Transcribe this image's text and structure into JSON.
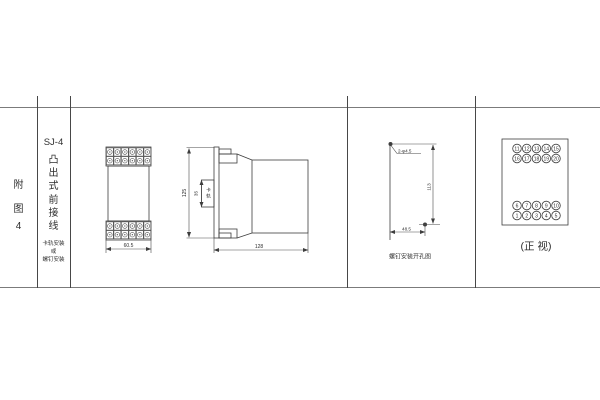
{
  "page": {
    "background": "#ffffff",
    "line_color": "#3d3d3d"
  },
  "title_block": {
    "figure_chars": [
      "附",
      "图",
      "4"
    ],
    "model": "SJ-4",
    "type_chars": [
      "凸",
      "出",
      "式",
      "前",
      "接",
      "线"
    ],
    "mount_lines": [
      "卡轨安装",
      "或",
      "螺钉安装"
    ]
  },
  "front_outline_view": {
    "terminal_grid": {
      "rows": 2,
      "cols": 6
    },
    "width_dim": "60.5"
  },
  "side_view": {
    "height_dim": "125",
    "rail_slot_dim": "35",
    "rail_slot_label_chars": [
      "卡",
      "轨"
    ],
    "depth_dim": "128"
  },
  "drill_view": {
    "holes_label": "2-φ4.5",
    "vertical_dim": "113",
    "horizontal_dim": "48.5",
    "caption": "螺钉安装开孔图"
  },
  "terminal_view": {
    "rows": [
      [
        "11",
        "12",
        "13",
        "14",
        "15"
      ],
      [
        "16",
        "17",
        "18",
        "19",
        "20"
      ],
      [
        "6",
        "7",
        "8",
        "9",
        "10"
      ],
      [
        "1",
        "2",
        "3",
        "4",
        "5"
      ]
    ],
    "caption": "(正 视)"
  }
}
